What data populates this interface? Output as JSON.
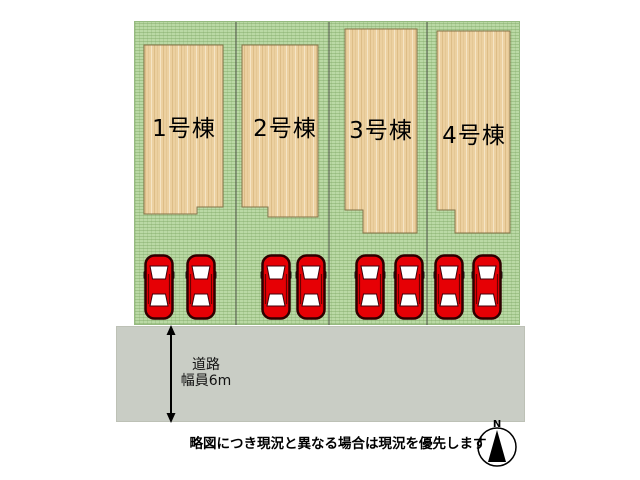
{
  "site_plan": {
    "lots": [
      {
        "label": "1号棟"
      },
      {
        "label": "2号棟"
      },
      {
        "label": "3号棟"
      },
      {
        "label": "4号棟"
      }
    ],
    "road": {
      "line1": "道路",
      "line2": "幅員6m"
    },
    "caption": "略図につき現況と異なる場合は現況を優先します",
    "compass": {
      "north_label": "N"
    },
    "parking": {
      "car_count": 8,
      "cars_per_lot": [
        2,
        2,
        2,
        2
      ]
    },
    "colors": {
      "site_green": "#bad9a5",
      "building_wood": "#ecd0a0",
      "road_gray": "#c9cdc5",
      "car_red": "#e60005"
    }
  }
}
